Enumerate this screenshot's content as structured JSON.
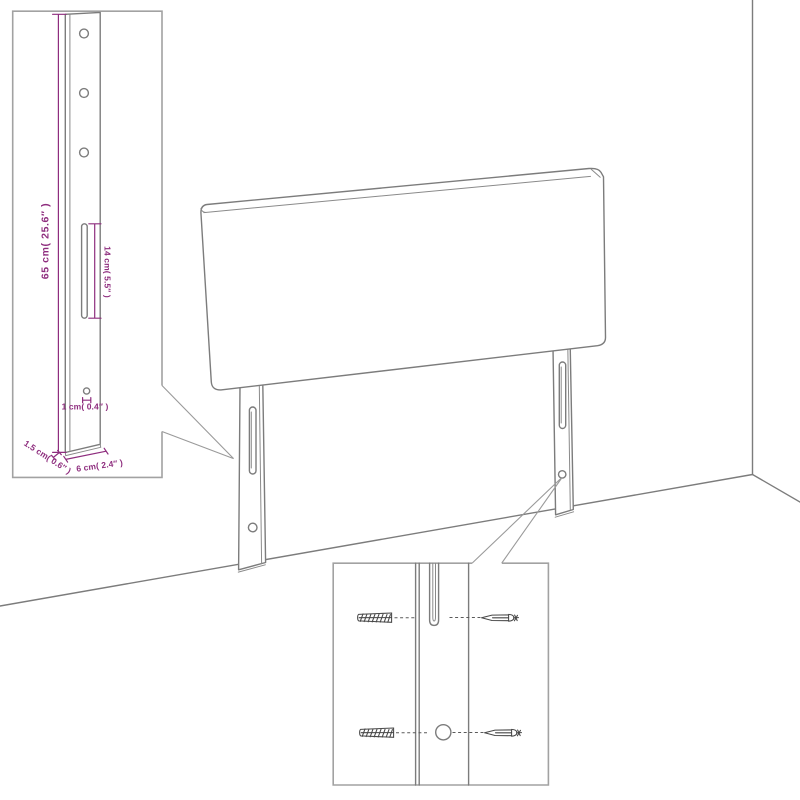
{
  "diagram": {
    "kind": "furniture-dimension-illustration",
    "subject": "headboard-with-mounting-legs-in-room-corner"
  },
  "colors": {
    "background": "#ffffff",
    "drawing_line": "#7c7c7c",
    "inset_border": "#a2a2a2",
    "dimension": "#8e2d7e",
    "hardware_sketch": "#474747"
  },
  "leg_detail_inset": {
    "dim_height": "65 cm( 25.6″ )",
    "dim_slot": "14 cm( 5.5″ )",
    "dim_hole": "1 cm( 0.4″ )",
    "dim_thickness": "1.5 cm( 0.6″ )",
    "dim_width": "6 cm( 2.4″ )"
  },
  "mounting_detail_inset": {
    "parts": [
      "wall-plug",
      "leg-slot",
      "screw",
      "wall-plug",
      "leg-hole",
      "screw"
    ]
  }
}
